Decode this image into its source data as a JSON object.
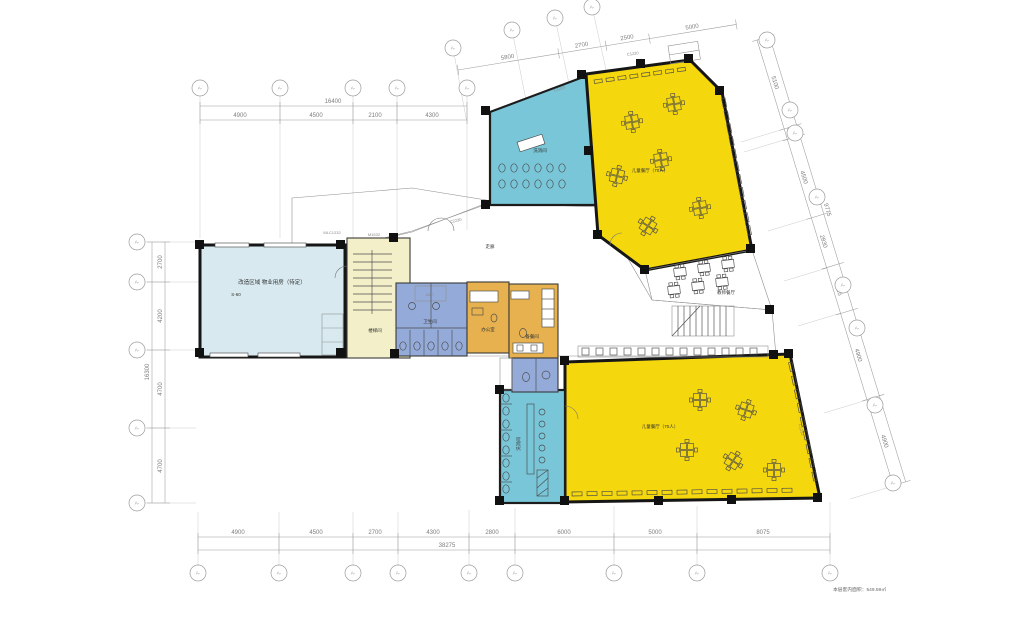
{
  "grid": {
    "bubble_label": "A-"
  },
  "dims": {
    "top_left": {
      "total": "16400",
      "segments": [
        "4900",
        "4500",
        "2100",
        "4300"
      ]
    },
    "top_slanted": {
      "segments": [
        "5800",
        "2700",
        "2500",
        "5000"
      ]
    },
    "left": {
      "total": "16300",
      "segments": [
        "2700",
        "4200",
        "4700",
        "4700"
      ]
    },
    "bottom": {
      "total": "38275",
      "segments": [
        "4900",
        "4500",
        "2700",
        "4300",
        "2800",
        "6000",
        "5000",
        "8075"
      ]
    },
    "right": {
      "outer_total": "9775",
      "segments": [
        "5100",
        "600",
        "4500",
        "2830",
        "2615",
        "4900",
        "4900"
      ]
    }
  },
  "rooms": {
    "left_hall": {
      "label": "改造区域 物业用房（待定）",
      "sublabel": "S-60"
    },
    "corridor": {
      "label": "走廊"
    },
    "stair_room": {
      "label": "楼梯间"
    },
    "wash_top": {
      "label": "洗消间"
    },
    "hall_top": {
      "label": "儿童餐厅（70人）"
    },
    "teacher_dining": {
      "label": "教师餐厅"
    },
    "hall_bottom": {
      "label": "儿童餐厅（70人）"
    },
    "toilet": {
      "label": "卫生间"
    },
    "office": {
      "label": "办公室"
    },
    "pantry": {
      "label": "备餐间"
    },
    "wash_bottom": {
      "label": "洗消间"
    }
  },
  "tags": {
    "t1": "C1220",
    "t2": "C1225",
    "t3": "M1532",
    "t4": "MLC1232",
    "t5": "C2230",
    "t6": "C1232",
    "t7": "A5.7"
  },
  "note": {
    "area": "本层套内面积：549.59㎡"
  },
  "colors": {
    "hall_yellow": "#f5d70d",
    "teal": "#79c6d8",
    "corridor_green": "#b8d8a3",
    "cream": "#f0edb5",
    "stair_cream": "#f3f0c9",
    "left_hall_blue": "#d8eaf0",
    "teacher_blue": "#cfe4ee",
    "toilet_blue": "#94abd9",
    "office_orange": "#e6b14e",
    "wall": "#161616"
  }
}
